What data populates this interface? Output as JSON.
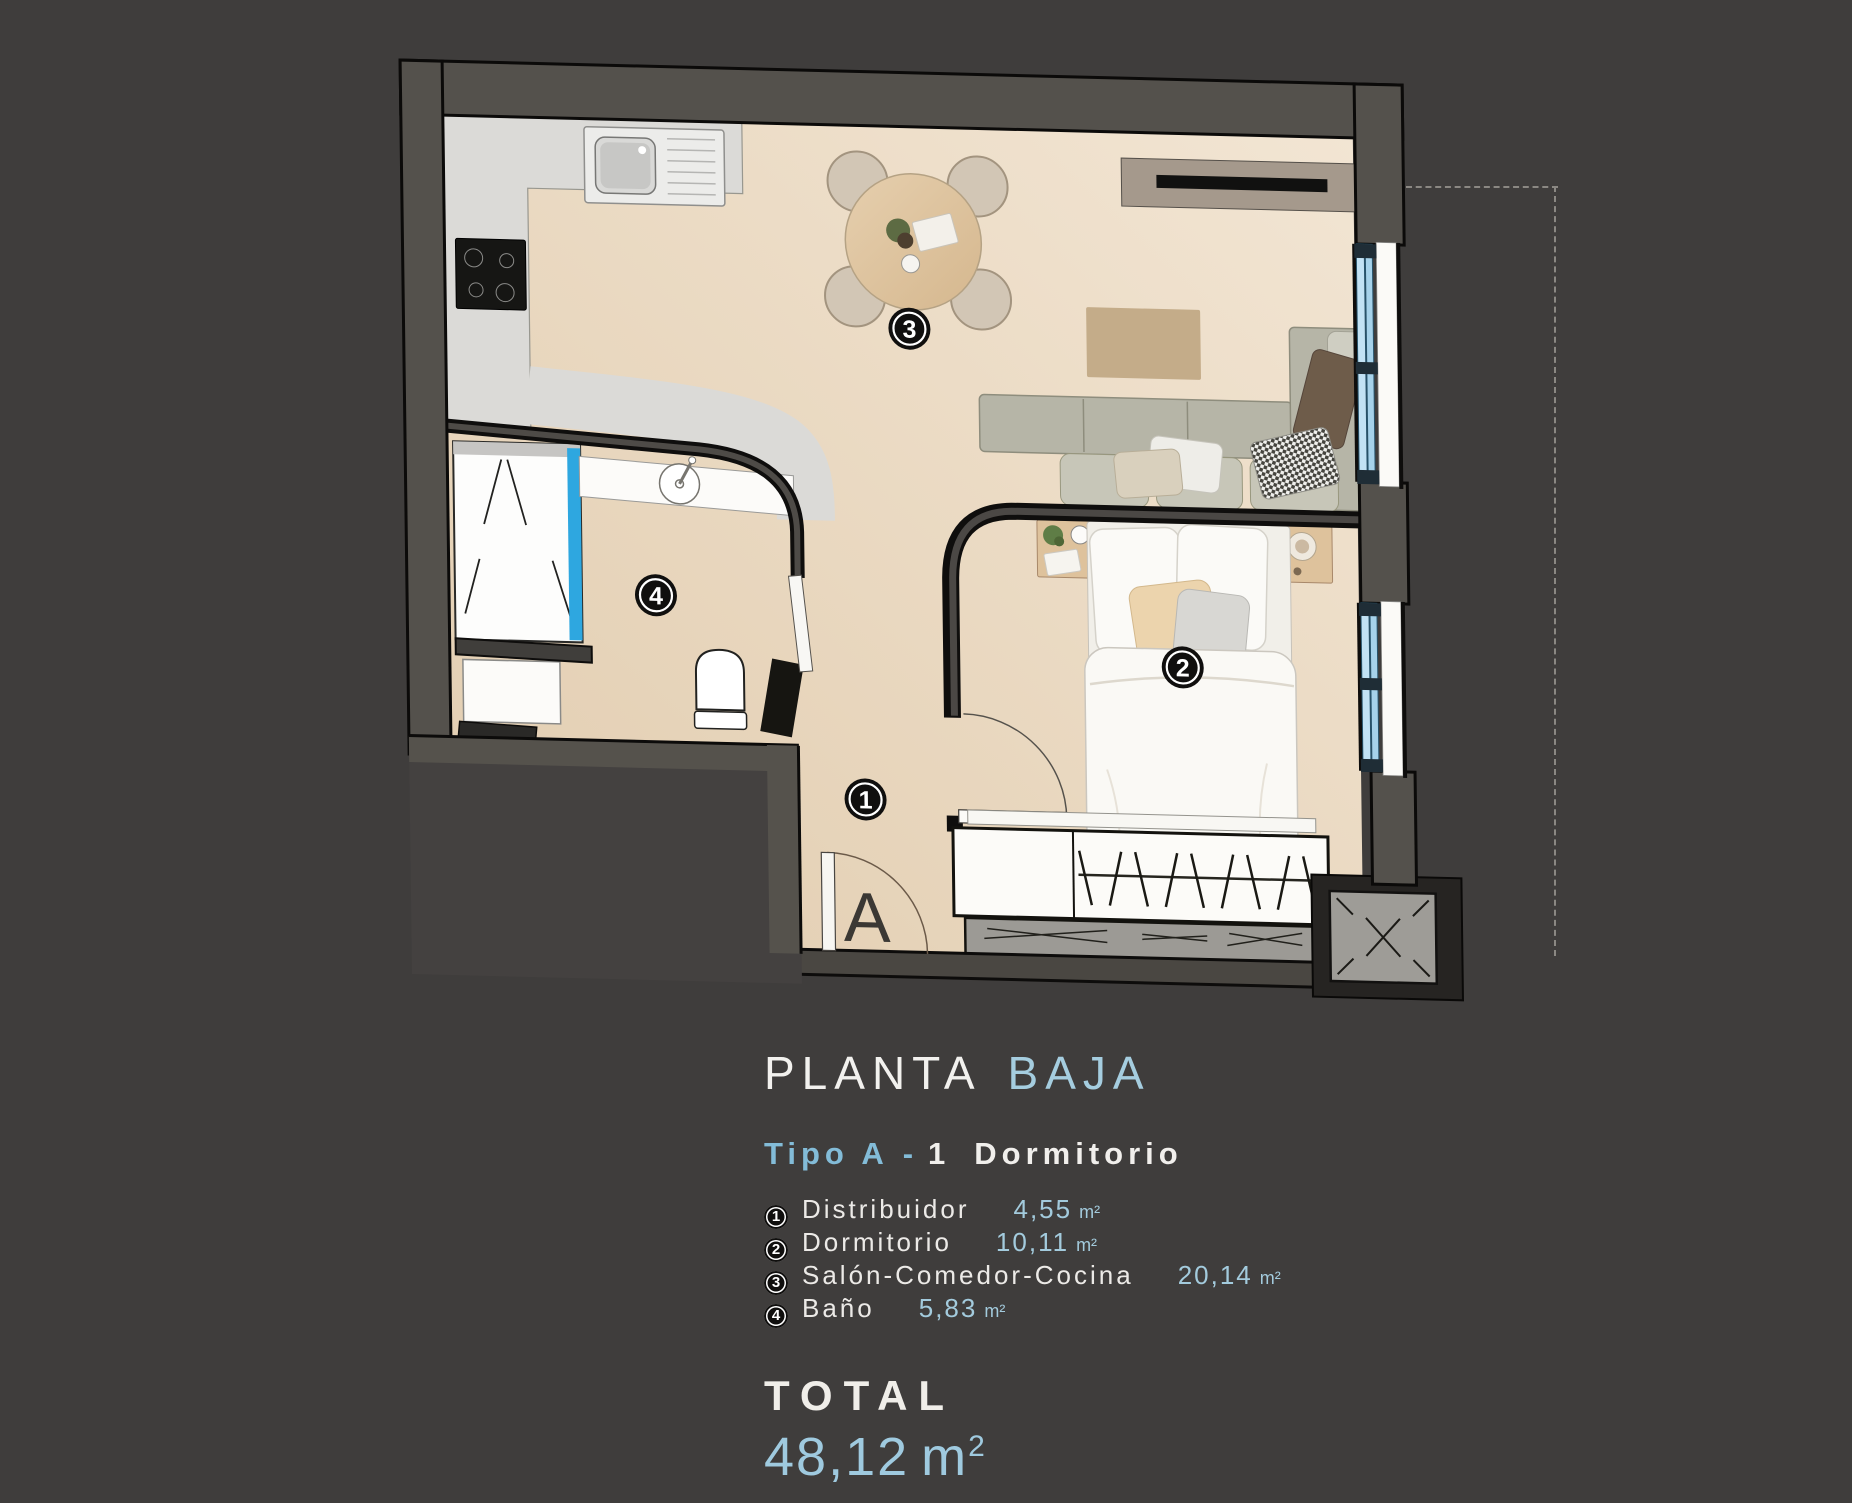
{
  "page": {
    "background": "#3f3d3c"
  },
  "title": {
    "primary": "PLANTA",
    "secondary": "BAJA"
  },
  "subtitle": {
    "type": "Tipo A",
    "separator": "-",
    "number": "1",
    "label": "Dormitorio"
  },
  "legend": [
    {
      "num": "1",
      "label": "Distribuidor",
      "value": "4,55",
      "unit": "m²"
    },
    {
      "num": "2",
      "label": "Dormitorio",
      "value": "10,11",
      "unit": "m²"
    },
    {
      "num": "3",
      "label": "Salón-Comedor-Cocina",
      "value": "20,14",
      "unit": "m²"
    },
    {
      "num": "4",
      "label": "Baño",
      "value": "5,83",
      "unit": "m²"
    }
  ],
  "total": {
    "label": "TOTAL",
    "value": "48,12",
    "unit": "m",
    "sup": "2"
  },
  "plan": {
    "entrance_label": "A",
    "badges": [
      {
        "number": "1"
      },
      {
        "number": "2"
      },
      {
        "number": "3"
      },
      {
        "number": "4"
      }
    ],
    "colors": {
      "wall": "#53504b",
      "floor": "#ead9c1",
      "counter": "#dbdad7",
      "shower_glass": "#2ea7e0",
      "window_glass": "#b5dcf2",
      "accent_text": "#a3cbdd"
    }
  }
}
